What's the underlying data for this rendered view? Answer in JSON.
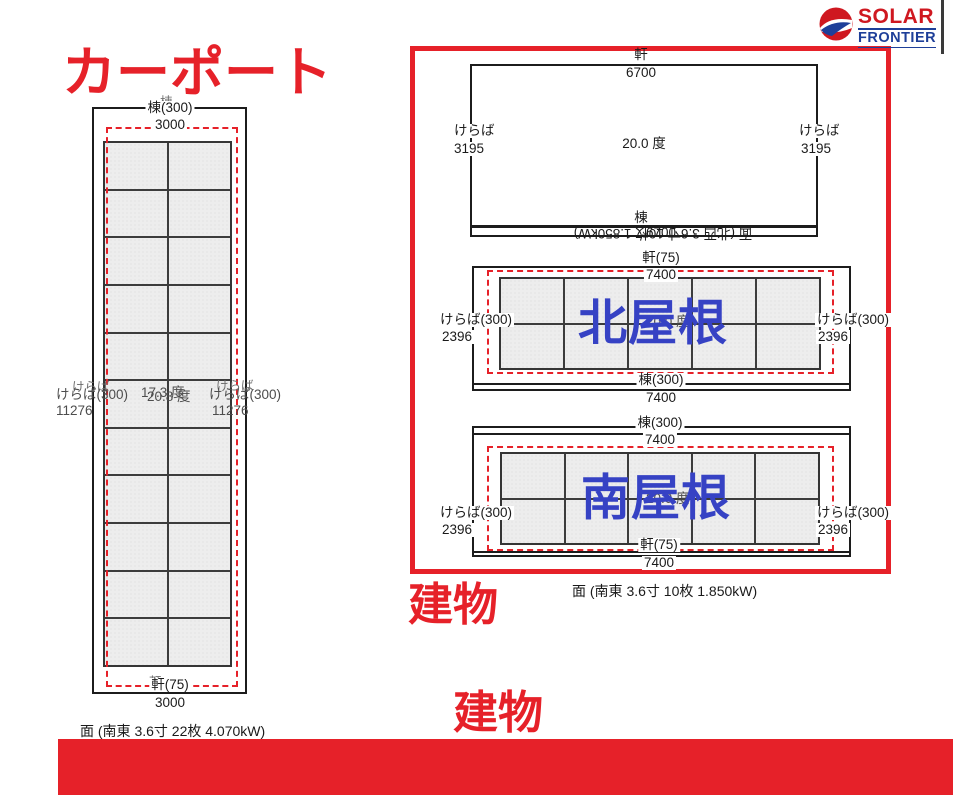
{
  "colors": {
    "accent_red": "#e62129",
    "overlay_blue": "#3642c4",
    "logo_red": "#cf1820",
    "logo_navy": "#1e3f99",
    "panel_fill": "#ededed"
  },
  "logo": {
    "top": "SOLAR",
    "bottom": "FRONTIER"
  },
  "headings": {
    "carport": "カーポート",
    "building_box": "建物",
    "building_lower": "建物"
  },
  "carport": {
    "ridge_ghost": "棟",
    "ridge_label": "棟(300)",
    "ridge_dim": "3000",
    "left_gable_ghost": "けらば",
    "left_gable_label": "けらば(300)",
    "left_gable_dim": "11276",
    "right_gable_ghost": "けらば",
    "right_gable_label": "けらば(300)",
    "right_gable_dim": "11276",
    "angle_text_a": "17.3 度",
    "angle_text_b": "20.8 度",
    "eave_ghost": "軒",
    "eave_label": "軒(75)",
    "eave_dim": "3000",
    "caption": "面 (南東 3.6寸 22枚 4.070kW)",
    "grid": {
      "cols": 2,
      "rows": 11
    }
  },
  "upper_roof": {
    "eave_label": "軒",
    "eave_dim": "6700",
    "left_gable_label": "けらば",
    "left_gable_dim": "3195",
    "right_gable_label": "けらば",
    "right_gable_dim": "3195",
    "angle_text": "20.0 度",
    "ridge_label": "棟",
    "ridge_dim": "6700",
    "flipped_caption": "面 (北西 3.6寸 10枚 1.850kW)"
  },
  "north_roof": {
    "name_overlay": "北屋根",
    "eave_label": "軒(75)",
    "eave_dim": "7400",
    "left_gable_label": "けらば(300)",
    "left_gable_dim": "2396",
    "right_gable_label": "けらば(300)",
    "right_gable_dim": "2396",
    "ridge_label": "棟(300)",
    "ridge_dim": "7400",
    "angle_text": "20.0 度",
    "grid": {
      "cols": 5,
      "rows": 2
    }
  },
  "south_roof": {
    "name_overlay": "南屋根",
    "ridge_label": "棟(300)",
    "ridge_dim": "7400",
    "left_gable_label": "けらば(300)",
    "left_gable_dim": "2396",
    "right_gable_label": "けらば(300)",
    "right_gable_dim": "2396",
    "eave_label": "軒(75)",
    "eave_dim": "7400",
    "angle_text": "20.0 度",
    "caption": "面 (南東 3.6寸 10枚 1.850kW)",
    "grid": {
      "cols": 5,
      "rows": 2
    }
  }
}
